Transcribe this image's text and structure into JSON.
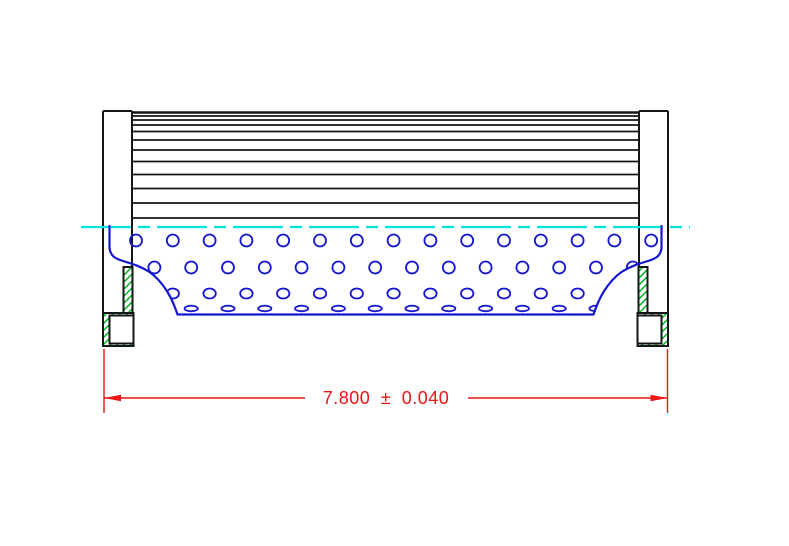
{
  "title": "Filter element cross-section engineering drawing",
  "dimension": {
    "display": "7.800  ±  0.040",
    "value": "7.800",
    "plus_minus": "±",
    "tolerance": "0.040"
  },
  "colors": {
    "background": "#ffffff",
    "outline": "#161616",
    "perforation_blue": "#1616d1",
    "centerline_cyan": "#00e4e4",
    "hatch_green": "#00b41e",
    "dimension_red": "#ed1414"
  },
  "drawing": {
    "width": 789,
    "height": 546,
    "mirror_axis": 771,
    "pleats": {
      "x1": 132,
      "x2": 639,
      "line_ys": [
        112.5,
        116,
        120,
        125,
        131.5,
        140,
        150,
        161.5,
        174.5,
        188.5,
        203,
        218
      ],
      "top_line_width": 2.4,
      "line_width": 1.8
    },
    "cap": {
      "stroke_width": 2,
      "lines": [
        [
          103,
          111,
          132,
          111
        ],
        [
          103,
          111,
          103,
          313
        ],
        [
          132,
          111,
          132,
          268
        ]
      ],
      "rects": [
        [
          123.5,
          267,
          9,
          46
        ],
        [
          103,
          313,
          30.5,
          33
        ],
        [
          109.5,
          315.5,
          24,
          28
        ]
      ],
      "hatch_rects": [
        [
          123.5,
          267,
          9,
          46
        ]
      ],
      "hatch_frames": [
        {
          "outer": [
            103,
            313,
            30.5,
            33
          ],
          "inner": [
            109.5,
            315.5,
            24,
            28
          ]
        }
      ]
    },
    "core": {
      "profile": "M 109.5 226 L 109.5 248 C 110.5 256 115 258.5 123 261 C 133 264 141 266.5 149.5 272 C 157.5 277.5 162.5 284 167.5 292 C 171.5 298.5 174.5 305.5 177.5 314.5 L 593.5 314.5 C 596.5 305.5 599.5 298.5 603.5 292 C 608.5 284 613.5 277.5 621.5 272 C 630 266.5 638 264 648 261 C 656 258.5 660.5 256 661.5 248 L 661.5 226",
      "profile_stroke_width": 2.2,
      "hole_stroke_width": 1.8,
      "pitch": 36.8,
      "rows": [
        {
          "y": 240.5,
          "x0": 136,
          "count": 15,
          "rx": 6,
          "ry": 6
        },
        {
          "y": 267.5,
          "x0": 154.4,
          "count": 14,
          "rx": 6,
          "ry": 6
        },
        {
          "y": 293.5,
          "x0": 136,
          "count": 15,
          "rx": 6.2,
          "ry": 5
        },
        {
          "y": 308.5,
          "x0": 154.4,
          "count": 14,
          "rx": 6.6,
          "ry": 2.8
        }
      ]
    },
    "centerline": {
      "y": 227,
      "x1": 81,
      "x2": 690,
      "dash": "50 7 12 7",
      "stroke_width": 2.2
    },
    "dim": {
      "stroke_width": 1.4,
      "ext_lines": [
        [
          104,
          349,
          104,
          413
        ],
        [
          667.5,
          349,
          667.5,
          413
        ]
      ],
      "segments": [
        [
          104,
          398,
          305,
          398
        ],
        [
          468,
          398,
          667.5,
          398
        ]
      ],
      "arrows": [
        {
          "tip_x": 104,
          "y": 398,
          "dir": 1
        },
        {
          "tip_x": 667.5,
          "y": 398,
          "dir": -1
        }
      ],
      "arrow_len": 17,
      "arrow_half_w": 3.2,
      "text_x": 386,
      "text_y": 404,
      "font_size": 18
    }
  }
}
